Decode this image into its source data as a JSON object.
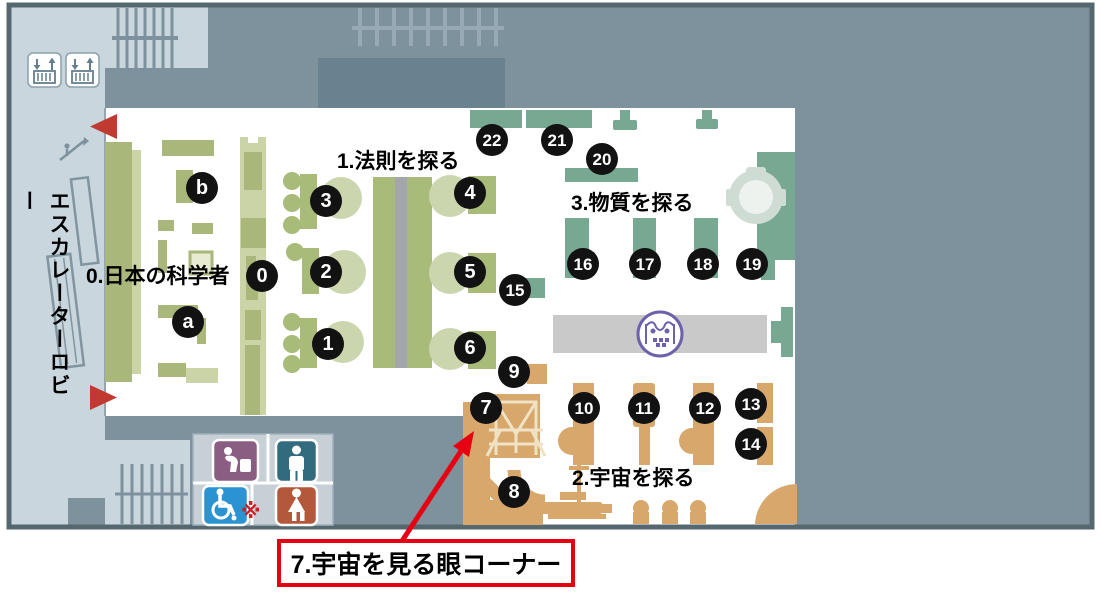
{
  "map": {
    "title_labels": {
      "lobby": "エスカレーターロビー",
      "zone0": "0.日本の科学者",
      "zone1": "1.法則を探る",
      "zone2": "2.宇宙を探る",
      "zone3": "3.物質を探る"
    },
    "callout": {
      "text": "7.宇宙を見る眼コーナー"
    },
    "note_mark": "※",
    "markers": [
      {
        "id": "b",
        "x": 202,
        "y": 188
      },
      {
        "id": "0",
        "x": 262,
        "y": 276
      },
      {
        "id": "a",
        "x": 188,
        "y": 322
      },
      {
        "id": "3",
        "x": 326,
        "y": 201
      },
      {
        "id": "2",
        "x": 326,
        "y": 272
      },
      {
        "id": "1",
        "x": 328,
        "y": 344
      },
      {
        "id": "4",
        "x": 470,
        "y": 193
      },
      {
        "id": "5",
        "x": 470,
        "y": 272
      },
      {
        "id": "6",
        "x": 470,
        "y": 348
      },
      {
        "id": "15",
        "x": 515,
        "y": 290
      },
      {
        "id": "9",
        "x": 514,
        "y": 372
      },
      {
        "id": "7",
        "x": 486,
        "y": 408
      },
      {
        "id": "8",
        "x": 514,
        "y": 492
      },
      {
        "id": "22",
        "x": 492,
        "y": 140
      },
      {
        "id": "21",
        "x": 557,
        "y": 140
      },
      {
        "id": "20",
        "x": 602,
        "y": 159
      },
      {
        "id": "16",
        "x": 583,
        "y": 264
      },
      {
        "id": "17",
        "x": 645,
        "y": 264
      },
      {
        "id": "18",
        "x": 703,
        "y": 264
      },
      {
        "id": "19",
        "x": 752,
        "y": 264
      },
      {
        "id": "10",
        "x": 584,
        "y": 408
      },
      {
        "id": "11",
        "x": 644,
        "y": 408
      },
      {
        "id": "12",
        "x": 705,
        "y": 408
      },
      {
        "id": "13",
        "x": 751,
        "y": 404
      },
      {
        "id": "14",
        "x": 751,
        "y": 444
      }
    ],
    "icons": [
      {
        "name": "elevator",
        "color": "#647f8c"
      },
      {
        "name": "escalator",
        "color": "#7e929e"
      },
      {
        "name": "stairs",
        "color": "#7e929e"
      },
      {
        "name": "drinking-fountain",
        "color": "#8a5d82"
      },
      {
        "name": "mens-restroom",
        "color": "#326b7e"
      },
      {
        "name": "wheelchair-accessible",
        "color": "#2b93d1"
      },
      {
        "name": "womens-restroom",
        "color": "#b3583a"
      },
      {
        "name": "museum-logo",
        "color": "#6c61ab"
      },
      {
        "name": "entrance-arrow",
        "color": "#c13a31"
      }
    ],
    "colors": {
      "corridor_gray": "#7e929e",
      "lobby_blue": "#c9d6dd",
      "zone0_olive": "#a9b77a",
      "zone1_olive": "#a9bb79",
      "zone1_pale_circle": "#ccd6ae",
      "zone2_tan": "#d8a76c",
      "zone3_green": "#77a891",
      "walkway_gray": "#c9c9c9",
      "marker_black": "#121212",
      "callout_red": "#e60012",
      "arrow_red": "#c13a31",
      "logo_purple": "#6c61ab"
    }
  }
}
